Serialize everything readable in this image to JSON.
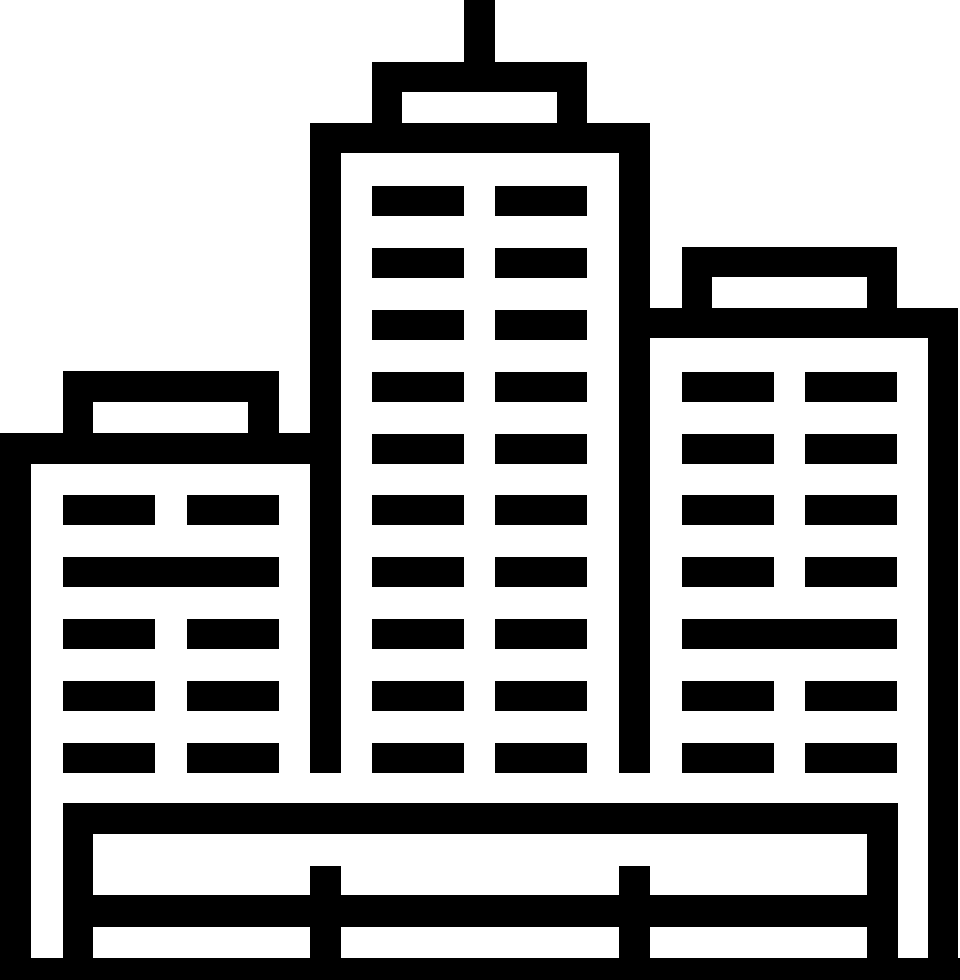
{
  "page": {
    "background": "#ffffff",
    "width": 960,
    "height": 980
  },
  "icon": {
    "name": "city-buildings",
    "description": "Black pictogram of a city skyline: tall center tower with rooftop antenna, shorter left and right buildings with window bars, standing behind a fenced ground platform",
    "fill": "#000000",
    "background": "#ffffff",
    "canvas": {
      "width": 960,
      "height": 980
    },
    "rects": [
      {
        "name": "antenna",
        "x": 464,
        "y": 0,
        "w": 31,
        "h": 62
      },
      {
        "name": "center-cap-top",
        "x": 372,
        "y": 62,
        "w": 215,
        "h": 30
      },
      {
        "name": "center-cap-wall-left",
        "x": 372,
        "y": 92,
        "w": 30,
        "h": 31
      },
      {
        "name": "center-cap-wall-right",
        "x": 557,
        "y": 92,
        "w": 30,
        "h": 31
      },
      {
        "name": "center-roof-band",
        "x": 310,
        "y": 123,
        "w": 340,
        "h": 30
      },
      {
        "name": "center-wall-left",
        "x": 310,
        "y": 153,
        "w": 31,
        "h": 620
      },
      {
        "name": "center-wall-right",
        "x": 619,
        "y": 153,
        "w": 31,
        "h": 620
      },
      {
        "name": "center-window-1a",
        "x": 372,
        "y": 186,
        "w": 92,
        "h": 30
      },
      {
        "name": "center-window-1b",
        "x": 495,
        "y": 186,
        "w": 92,
        "h": 30
      },
      {
        "name": "center-window-2a",
        "x": 372,
        "y": 248,
        "w": 92,
        "h": 30
      },
      {
        "name": "center-window-2b",
        "x": 495,
        "y": 248,
        "w": 92,
        "h": 30
      },
      {
        "name": "center-window-3a",
        "x": 372,
        "y": 310,
        "w": 92,
        "h": 30
      },
      {
        "name": "center-window-3b",
        "x": 495,
        "y": 310,
        "w": 92,
        "h": 30
      },
      {
        "name": "center-window-4a",
        "x": 372,
        "y": 372,
        "w": 92,
        "h": 30
      },
      {
        "name": "center-window-4b",
        "x": 495,
        "y": 372,
        "w": 92,
        "h": 30
      },
      {
        "name": "center-window-5a",
        "x": 372,
        "y": 434,
        "w": 92,
        "h": 30
      },
      {
        "name": "center-window-5b",
        "x": 495,
        "y": 434,
        "w": 92,
        "h": 30
      },
      {
        "name": "center-window-6a",
        "x": 372,
        "y": 495,
        "w": 92,
        "h": 30
      },
      {
        "name": "center-window-6b",
        "x": 495,
        "y": 495,
        "w": 92,
        "h": 30
      },
      {
        "name": "center-window-7a",
        "x": 372,
        "y": 557,
        "w": 92,
        "h": 30
      },
      {
        "name": "center-window-7b",
        "x": 495,
        "y": 557,
        "w": 92,
        "h": 30
      },
      {
        "name": "center-window-8a",
        "x": 372,
        "y": 619,
        "w": 92,
        "h": 30
      },
      {
        "name": "center-window-8b",
        "x": 495,
        "y": 619,
        "w": 92,
        "h": 30
      },
      {
        "name": "center-window-9a",
        "x": 372,
        "y": 681,
        "w": 92,
        "h": 30
      },
      {
        "name": "center-window-9b",
        "x": 495,
        "y": 681,
        "w": 92,
        "h": 30
      },
      {
        "name": "center-window-10a",
        "x": 372,
        "y": 743,
        "w": 92,
        "h": 30
      },
      {
        "name": "center-window-10b",
        "x": 495,
        "y": 743,
        "w": 92,
        "h": 30
      },
      {
        "name": "left-cap-top",
        "x": 63,
        "y": 371,
        "w": 216,
        "h": 31
      },
      {
        "name": "left-cap-wall-left",
        "x": 63,
        "y": 402,
        "w": 30,
        "h": 31
      },
      {
        "name": "left-cap-wall-right",
        "x": 248,
        "y": 402,
        "w": 31,
        "h": 31
      },
      {
        "name": "left-roof-band",
        "x": 0,
        "y": 433,
        "w": 341,
        "h": 31
      },
      {
        "name": "outer-wall-left",
        "x": 0,
        "y": 464,
        "w": 31,
        "h": 516
      },
      {
        "name": "left-window-1a",
        "x": 63,
        "y": 495,
        "w": 92,
        "h": 30
      },
      {
        "name": "left-window-1b",
        "x": 187,
        "y": 495,
        "w": 92,
        "h": 30
      },
      {
        "name": "left-window-2-wide",
        "x": 63,
        "y": 557,
        "w": 216,
        "h": 30
      },
      {
        "name": "left-window-3a",
        "x": 63,
        "y": 619,
        "w": 92,
        "h": 30
      },
      {
        "name": "left-window-3b",
        "x": 187,
        "y": 619,
        "w": 92,
        "h": 30
      },
      {
        "name": "left-window-4a",
        "x": 63,
        "y": 681,
        "w": 92,
        "h": 30
      },
      {
        "name": "left-window-4b",
        "x": 187,
        "y": 681,
        "w": 92,
        "h": 30
      },
      {
        "name": "left-window-5a",
        "x": 63,
        "y": 743,
        "w": 92,
        "h": 30
      },
      {
        "name": "left-window-5b",
        "x": 187,
        "y": 743,
        "w": 92,
        "h": 30
      },
      {
        "name": "right-cap-top",
        "x": 682,
        "y": 247,
        "w": 215,
        "h": 30
      },
      {
        "name": "right-cap-wall-left",
        "x": 682,
        "y": 277,
        "w": 30,
        "h": 31
      },
      {
        "name": "right-cap-wall-right",
        "x": 867,
        "y": 277,
        "w": 30,
        "h": 31
      },
      {
        "name": "right-roof-band",
        "x": 650,
        "y": 308,
        "w": 308,
        "h": 30
      },
      {
        "name": "outer-wall-right",
        "x": 928,
        "y": 338,
        "w": 30,
        "h": 642
      },
      {
        "name": "right-window-1a",
        "x": 682,
        "y": 372,
        "w": 92,
        "h": 30
      },
      {
        "name": "right-window-1b",
        "x": 805,
        "y": 372,
        "w": 92,
        "h": 30
      },
      {
        "name": "right-window-2a",
        "x": 682,
        "y": 434,
        "w": 92,
        "h": 30
      },
      {
        "name": "right-window-2b",
        "x": 805,
        "y": 434,
        "w": 92,
        "h": 30
      },
      {
        "name": "right-window-3a",
        "x": 682,
        "y": 495,
        "w": 92,
        "h": 30
      },
      {
        "name": "right-window-3b",
        "x": 805,
        "y": 495,
        "w": 92,
        "h": 30
      },
      {
        "name": "right-window-4a",
        "x": 682,
        "y": 557,
        "w": 92,
        "h": 30
      },
      {
        "name": "right-window-4b",
        "x": 805,
        "y": 557,
        "w": 92,
        "h": 30
      },
      {
        "name": "right-window-5-wide",
        "x": 682,
        "y": 619,
        "w": 215,
        "h": 30
      },
      {
        "name": "right-window-6a",
        "x": 682,
        "y": 681,
        "w": 92,
        "h": 30
      },
      {
        "name": "right-window-6b",
        "x": 805,
        "y": 681,
        "w": 92,
        "h": 30
      },
      {
        "name": "right-window-7a",
        "x": 682,
        "y": 743,
        "w": 92,
        "h": 30
      },
      {
        "name": "right-window-7b",
        "x": 805,
        "y": 743,
        "w": 92,
        "h": 30
      },
      {
        "name": "base-top-rail",
        "x": 63,
        "y": 803,
        "w": 835,
        "h": 31
      },
      {
        "name": "base-wall-left",
        "x": 63,
        "y": 834,
        "w": 30,
        "h": 124
      },
      {
        "name": "base-wall-right",
        "x": 867,
        "y": 834,
        "w": 31,
        "h": 124
      },
      {
        "name": "base-post-left",
        "x": 310,
        "y": 866,
        "w": 31,
        "h": 92
      },
      {
        "name": "base-post-right",
        "x": 619,
        "y": 866,
        "w": 31,
        "h": 92
      },
      {
        "name": "base-mid-rail",
        "x": 63,
        "y": 895,
        "w": 835,
        "h": 32
      },
      {
        "name": "base-ground-band",
        "x": 0,
        "y": 958,
        "w": 960,
        "h": 22
      }
    ]
  }
}
